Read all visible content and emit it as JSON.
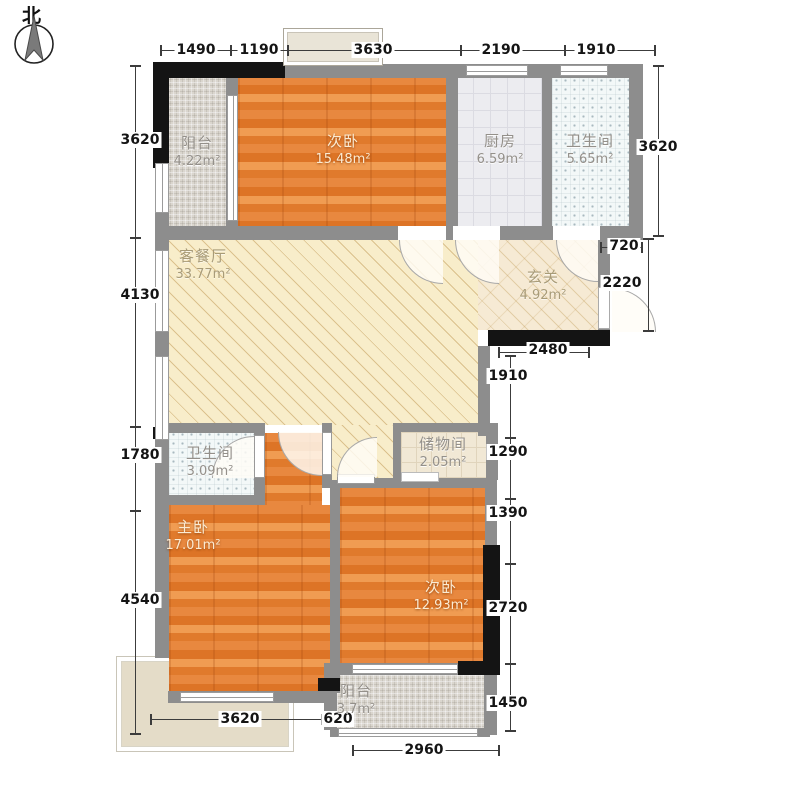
{
  "meta": {
    "compass_label": "北"
  },
  "rooms": {
    "balcony_top": {
      "name": "阳台",
      "area": "4.22m²"
    },
    "bedroom_top": {
      "name": "次卧",
      "area": "15.48m²"
    },
    "kitchen": {
      "name": "厨房",
      "area": "6.59m²"
    },
    "bath_top": {
      "name": "卫生间",
      "area": "5.65m²"
    },
    "living_dining": {
      "name": "客餐厅",
      "area": "33.77m²"
    },
    "hallway": {
      "name": "玄关",
      "area": "4.92m²"
    },
    "bath_mid": {
      "name": "卫生间",
      "area": "3.09m²"
    },
    "storage": {
      "name": "储物间",
      "area": "2.05m²"
    },
    "master_bedroom": {
      "name": "主卧",
      "area": "17.01m²"
    },
    "bedroom_bottom": {
      "name": "次卧",
      "area": "12.93m²"
    },
    "balcony_bottom": {
      "name": "阳台",
      "area": "3.7m²"
    }
  },
  "dims": {
    "top": [
      "1490",
      "1190",
      "3630",
      "2190",
      "1910"
    ],
    "left": [
      "3620",
      "4130",
      "1780",
      "4540"
    ],
    "right": [
      "3620",
      "720",
      "2220",
      "2480",
      "1910",
      "1290",
      "1390",
      "2720",
      "1450"
    ],
    "bottom": [
      "3620",
      "620",
      "2960"
    ]
  }
}
